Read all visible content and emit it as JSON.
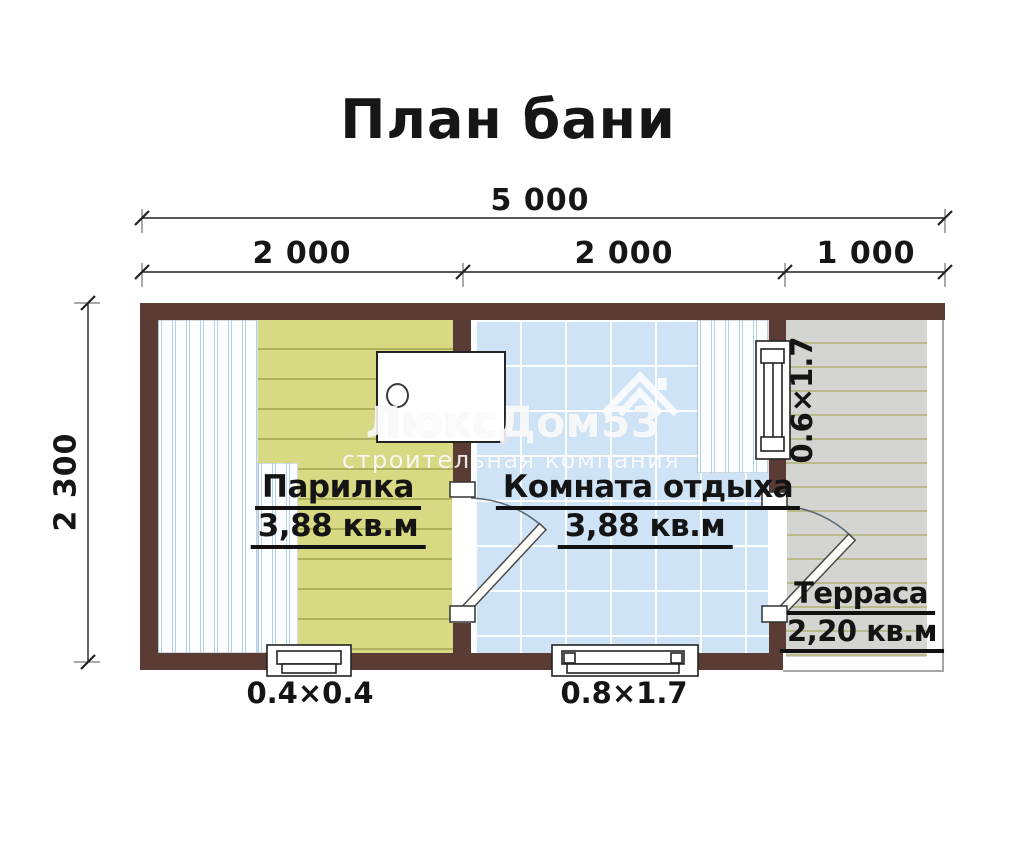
{
  "title": "План бани",
  "dimensions": {
    "total_width": "5 000",
    "segment_1": "2 000",
    "segment_2": "2 000",
    "segment_3": "1 000",
    "height": "2 300"
  },
  "rooms": [
    {
      "name": "Парилка",
      "area": "3,88 кв.м"
    },
    {
      "name": "Комната отдыха",
      "area": "3,88 кв.м"
    },
    {
      "name": "Терраса",
      "area": "2,20 кв.м"
    }
  ],
  "openings": {
    "bottom_window_small": "0.4×0.4",
    "bottom_window_large": "0.8×1.7",
    "side_window": "0.6×1.7"
  },
  "watermark": {
    "brand": "ЛюксДом53",
    "subtitle": "строительная компания"
  },
  "colors": {
    "wall": "#5a3c34",
    "steam_room_floor": "#d8d983",
    "rest_room_floor": "#cfe3f6",
    "terrace_floor": "#d4d4d0",
    "bench": "#fcfdff"
  }
}
